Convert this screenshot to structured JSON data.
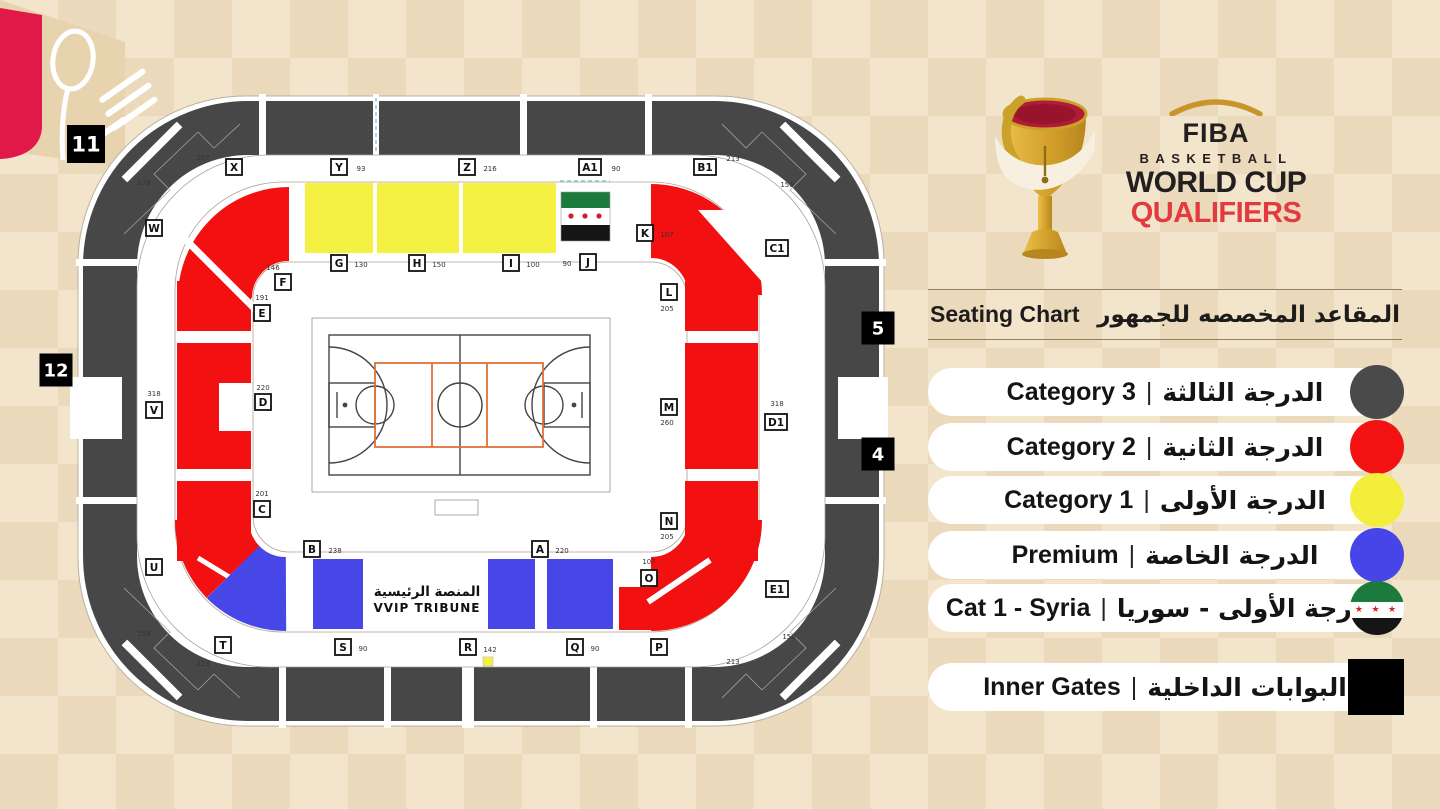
{
  "logo": {
    "fiba": "FIBA",
    "basketball": "BASKETBALL",
    "world_cup": "WORLD CUP",
    "qualifiers": "QUALIFIERS",
    "qualifiers_color": "#e23a3e",
    "gold": "#c9952b"
  },
  "title": {
    "en": "Seating Chart",
    "ar": "المقاعد المخصصه للجمهور"
  },
  "legend": {
    "separator": "|",
    "items": [
      {
        "en": "Category 3",
        "ar": "الدرجة الثالثة",
        "marker": "circle",
        "color": "#4a4a4a"
      },
      {
        "en": "Category 2",
        "ar": "الدرجة الثانية",
        "marker": "circle",
        "color": "#f31212"
      },
      {
        "en": "Category 1",
        "ar": "الدرجة الأولى",
        "marker": "circle",
        "color": "#f3ee3b"
      },
      {
        "en": "Premium",
        "ar": "الدرجة الخاصة",
        "marker": "circle",
        "color": "#4646e8"
      },
      {
        "en": "Cat 1 - Syria",
        "ar": "الدرجة الأولى - سوريا",
        "marker": "syria-flag"
      },
      {
        "en": "Inner Gates",
        "ar": "البوابات الداخلية",
        "marker": "square",
        "color": "#000000"
      }
    ]
  },
  "map": {
    "vvip": {
      "ar": "المنصة الرئيسية",
      "en": "VVIP TRIBUNE"
    },
    "gates": [
      "11",
      "12",
      "5",
      "4"
    ],
    "colors": {
      "category3": "#474747",
      "category2": "#f21010",
      "category1": "#f5f143",
      "premium": "#4747e8",
      "court_accent": "#e0703a"
    },
    "sections": [
      {
        "id": "X",
        "seats": "207"
      },
      {
        "id": "Y",
        "seats": "93"
      },
      {
        "id": "Z",
        "seats": "216"
      },
      {
        "id": "A1",
        "seats": "90"
      },
      {
        "id": "B1",
        "seats": "213"
      },
      {
        "id": "W",
        "seats": "176"
      },
      {
        "id": "V",
        "seats": "318"
      },
      {
        "id": "U",
        "seats": "158"
      },
      {
        "id": "T",
        "seats": "213"
      },
      {
        "id": "S",
        "seats": "90"
      },
      {
        "id": "R",
        "seats": "142"
      },
      {
        "id": "Q",
        "seats": "90"
      },
      {
        "id": "P",
        "seats": "213"
      },
      {
        "id": "O",
        "seats": "107"
      },
      {
        "id": "N",
        "seats": "205"
      },
      {
        "id": "M",
        "seats": "260"
      },
      {
        "id": "L",
        "seats": "205"
      },
      {
        "id": "K",
        "seats": "107"
      },
      {
        "id": "J",
        "seats": "90"
      },
      {
        "id": "I",
        "seats": "100"
      },
      {
        "id": "H",
        "seats": "150"
      },
      {
        "id": "G",
        "seats": "130"
      },
      {
        "id": "F",
        "seats": "146"
      },
      {
        "id": "E",
        "seats": "191"
      },
      {
        "id": "D",
        "seats": "220"
      },
      {
        "id": "C",
        "seats": "201"
      },
      {
        "id": "B",
        "seats": "238"
      },
      {
        "id": "A",
        "seats": "220"
      },
      {
        "id": "C1",
        "seats": "156"
      },
      {
        "id": "D1",
        "seats": "318"
      },
      {
        "id": "E1",
        "seats": "156"
      }
    ]
  }
}
